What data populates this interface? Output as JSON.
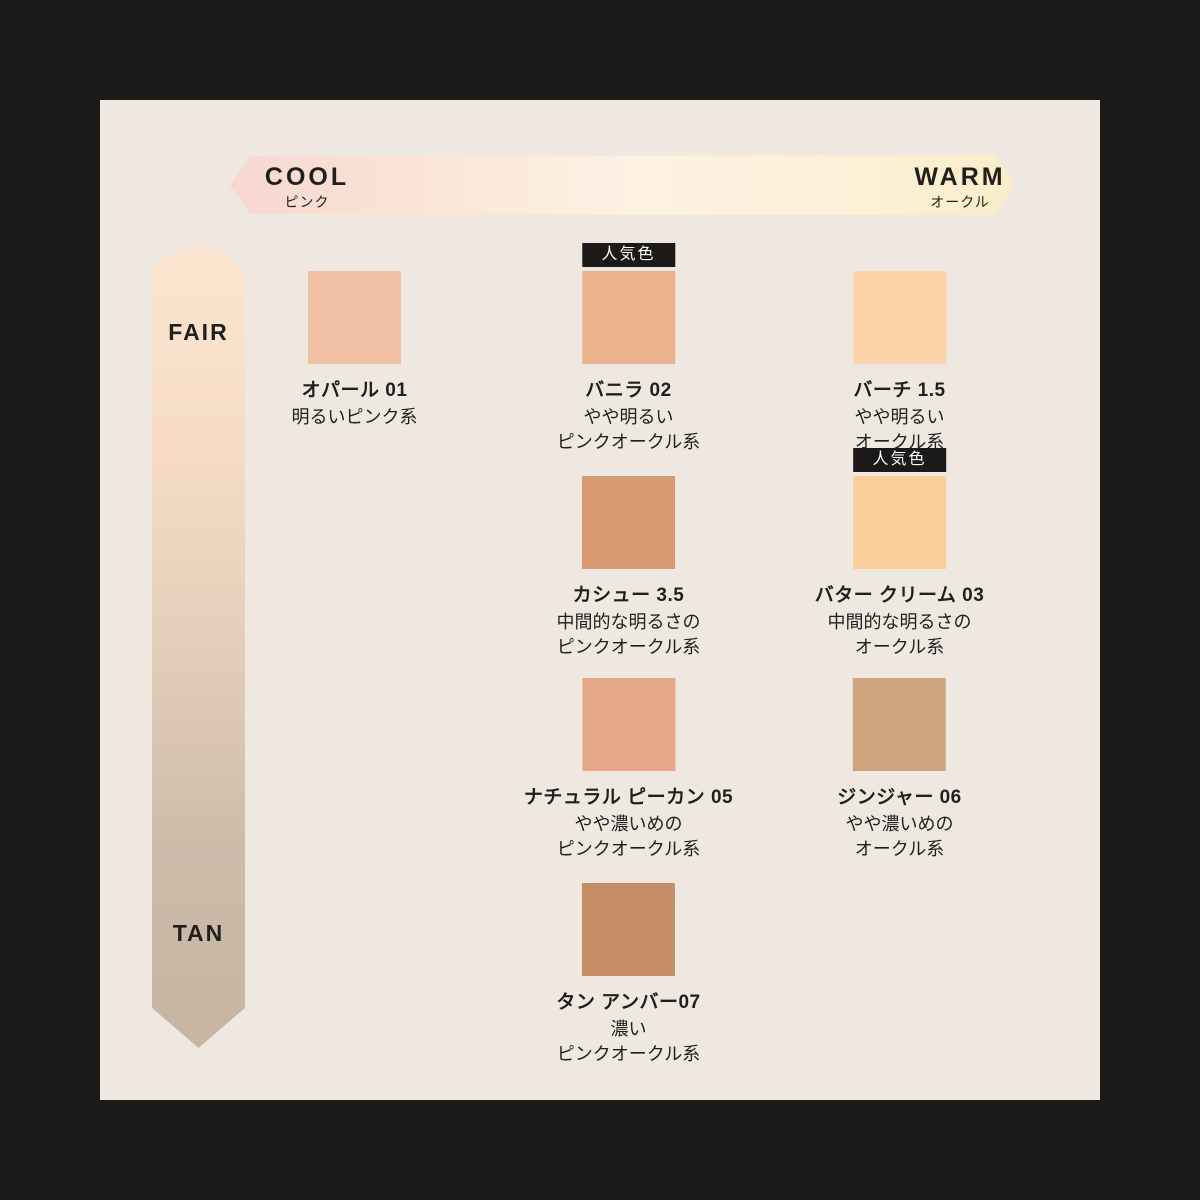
{
  "axes": {
    "horizontal": {
      "left_label": "COOL",
      "left_sublabel": "ピンク",
      "right_label": "WARM",
      "right_sublabel": "オークル",
      "gradient": [
        "#f8d7d1",
        "#fae5d6",
        "#fdf1e3",
        "#fdf0da",
        "#f9eec9"
      ]
    },
    "vertical": {
      "top_label": "FAIR",
      "bottom_label": "TAN",
      "gradient": [
        "#fce5d0",
        "#f6dcc6",
        "#e4ceb9",
        "#cdbbaa",
        "#c7b5a3"
      ]
    }
  },
  "popular_badge_label": "人気色",
  "colors": {
    "frame": "#1b1a18",
    "panel_bg": "#efe8e1",
    "text": "#201f1d",
    "badge_bg": "#1b1a18",
    "badge_text": "#ffffff"
  },
  "shades": [
    {
      "name": "オパール 01",
      "desc_lines": [
        "明るいピンク系"
      ],
      "color": "#efc0a3",
      "col": 1,
      "row": 1,
      "popular": false
    },
    {
      "name": "バニラ 02",
      "desc_lines": [
        "やや明るい",
        "ピンクオークル系"
      ],
      "color": "#ebb28e",
      "col": 2,
      "row": 1,
      "popular": true
    },
    {
      "name": "バーチ 1.5",
      "desc_lines": [
        "やや明るい",
        "オークル系"
      ],
      "color": "#fdd3a9",
      "col": 3,
      "row": 1,
      "popular": false
    },
    {
      "name": "カシュー 3.5",
      "desc_lines": [
        "中間的な明るさの",
        "ピンクオークル系"
      ],
      "color": "#d89a71",
      "col": 2,
      "row": 2,
      "popular": false
    },
    {
      "name": "バター クリーム 03",
      "desc_lines": [
        "中間的な明るさの",
        "オークル系"
      ],
      "color": "#fcce9c",
      "col": 3,
      "row": 2,
      "popular": true
    },
    {
      "name": "ナチュラル ピーカン 05",
      "desc_lines": [
        "やや濃いめの",
        "ピンクオークル系"
      ],
      "color": "#e5a987",
      "col": 2,
      "row": 3,
      "popular": false
    },
    {
      "name": "ジンジャー 06",
      "desc_lines": [
        "やや濃いめの",
        "オークル系"
      ],
      "color": "#cda47d",
      "col": 3,
      "row": 3,
      "popular": false
    },
    {
      "name": "タン アンバー07",
      "desc_lines": [
        "濃い",
        "ピンクオークル系"
      ],
      "color": "#c68e66",
      "col": 2,
      "row": 4,
      "popular": false
    }
  ]
}
